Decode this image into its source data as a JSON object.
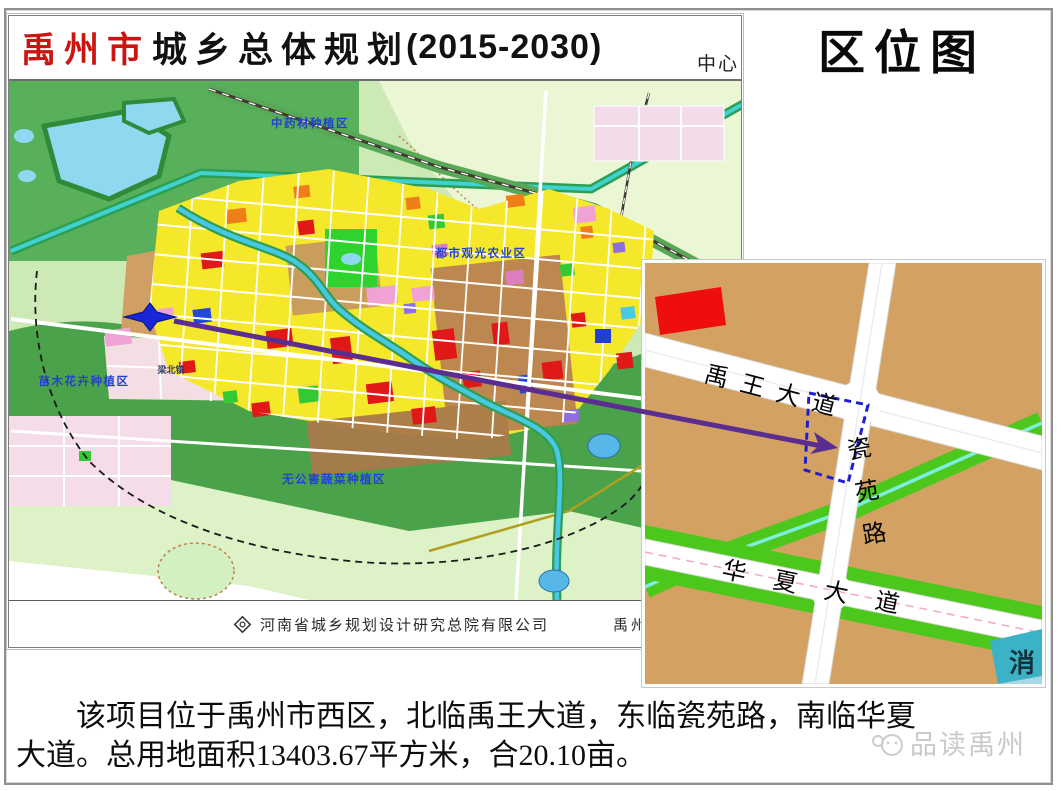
{
  "plan_map": {
    "title_city": "禹州市",
    "title_rest": "城乡总体规划",
    "title_year": "(2015-2030)",
    "corner_note": "中心",
    "region_labels": [
      {
        "text": "中药材种植区"
      },
      {
        "text": "都市观光农业区"
      },
      {
        "text": "苗木花卉种植区"
      },
      {
        "text": "无公害蔬菜种植区"
      },
      {
        "text": "梁北镇"
      }
    ],
    "footer_company": "河南省城乡规划设计研究总院有限公司",
    "footer_government": "禹州市人"
  },
  "location_map": {
    "heading": "区位图",
    "roads": [
      {
        "name": "禹王大道"
      },
      {
        "name": "瓷苑路"
      },
      {
        "name": "华夏大道"
      }
    ],
    "fire_station_label": "消",
    "colors": {
      "background": "#d3a263",
      "site_boundary": "#1f1fd0",
      "arrow": "#5c2d91",
      "marker": "#1626d8",
      "greenbelt": "#4cc81c",
      "river": "#7deede",
      "landmark_red": "#ee0e0e",
      "fire_station": "#3cb2c6"
    }
  },
  "caption": {
    "lines": [
      "该项目位于禹州市西区，北临禹王大道，东临瓷苑路，南临华夏",
      "大道。总用地面积13403.67平方米，合20.10亩。"
    ]
  },
  "watermark": {
    "text": "品读禹州"
  }
}
